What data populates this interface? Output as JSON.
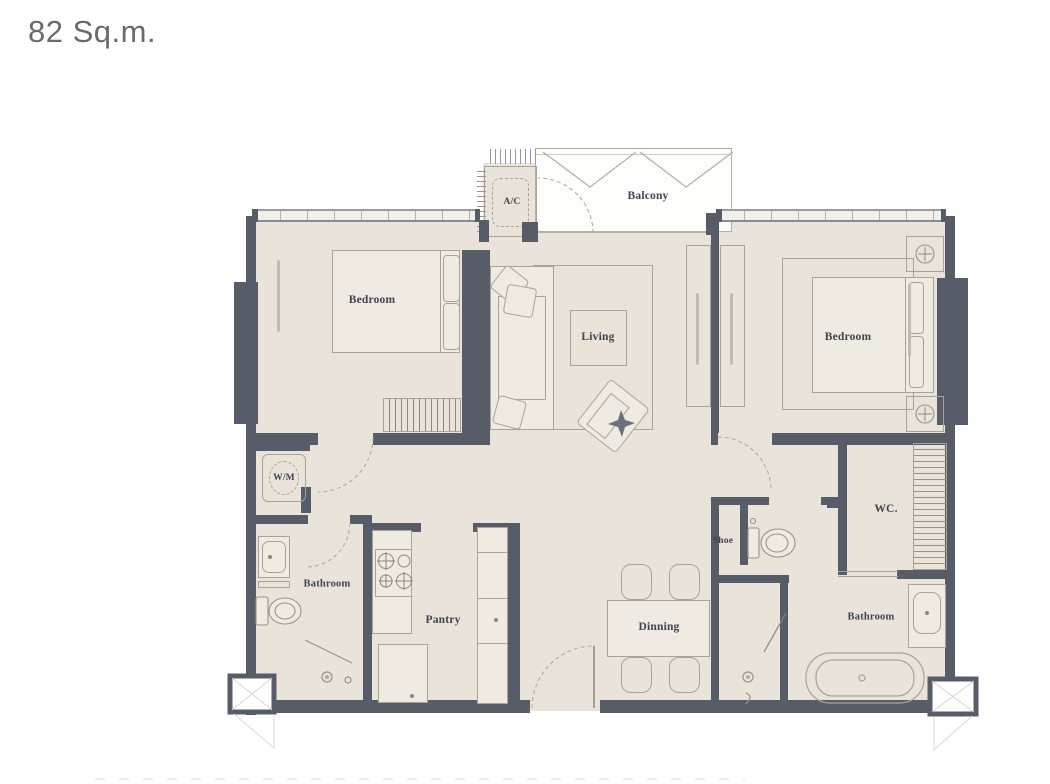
{
  "title": "82 Sq.m.",
  "colors": {
    "wall": "#575c69",
    "floor": "#e9e3da",
    "floor_light": "#efeae2",
    "line": "#aaa296",
    "line_light": "#c4bdb1",
    "label": "#3f4450",
    "title": "#6a6a6a"
  },
  "rooms": {
    "balcony": {
      "label": "Balcony"
    },
    "ac": {
      "label": "A/C"
    },
    "bedroom_left": {
      "label": "Bedroom"
    },
    "living": {
      "label": "Living"
    },
    "bedroom_right": {
      "label": "Bedroom"
    },
    "wm": {
      "label": "W/M"
    },
    "bathroom_left": {
      "label": "Bathroom"
    },
    "pantry": {
      "label": "Pantry"
    },
    "dining": {
      "label": "Dinning"
    },
    "shoe": {
      "label": "Shoe"
    },
    "wc": {
      "label": "WC."
    },
    "bathroom_right": {
      "label": "Bathroom"
    }
  }
}
